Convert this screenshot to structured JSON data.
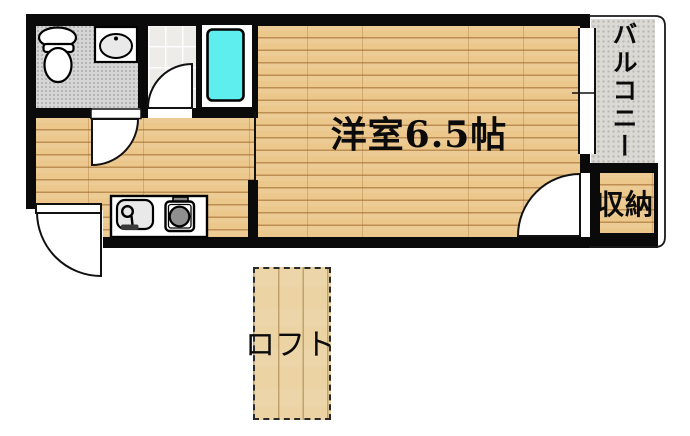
{
  "floorplan": {
    "rooms": {
      "main_room": {
        "label": "洋室6.5帖"
      },
      "balcony": {
        "label": "バルコニー"
      },
      "storage": {
        "label": "収納"
      },
      "loft": {
        "label": "ロフト"
      }
    },
    "fixtures": [
      "toilet",
      "washbasin",
      "bathtub",
      "kitchen-sink",
      "gas-stove",
      "toilet-room-door",
      "shower-room-door",
      "entrance-door",
      "storage-door",
      "balcony-window"
    ],
    "colors": {
      "wall": "#0a0a0a",
      "wood": "#ecc78c",
      "wood_line": "#c59a62",
      "loft_wood": "#ebd3a4",
      "loft_line": "#cdab77",
      "toilet_floor": "#d6d6d6",
      "shower_floor": "#edece8",
      "balcony_floor": "#dad9d4",
      "bathtub": "#5eeeed",
      "fixture_gray": "#e9e9e9",
      "burner": "#8f8f8f"
    }
  }
}
